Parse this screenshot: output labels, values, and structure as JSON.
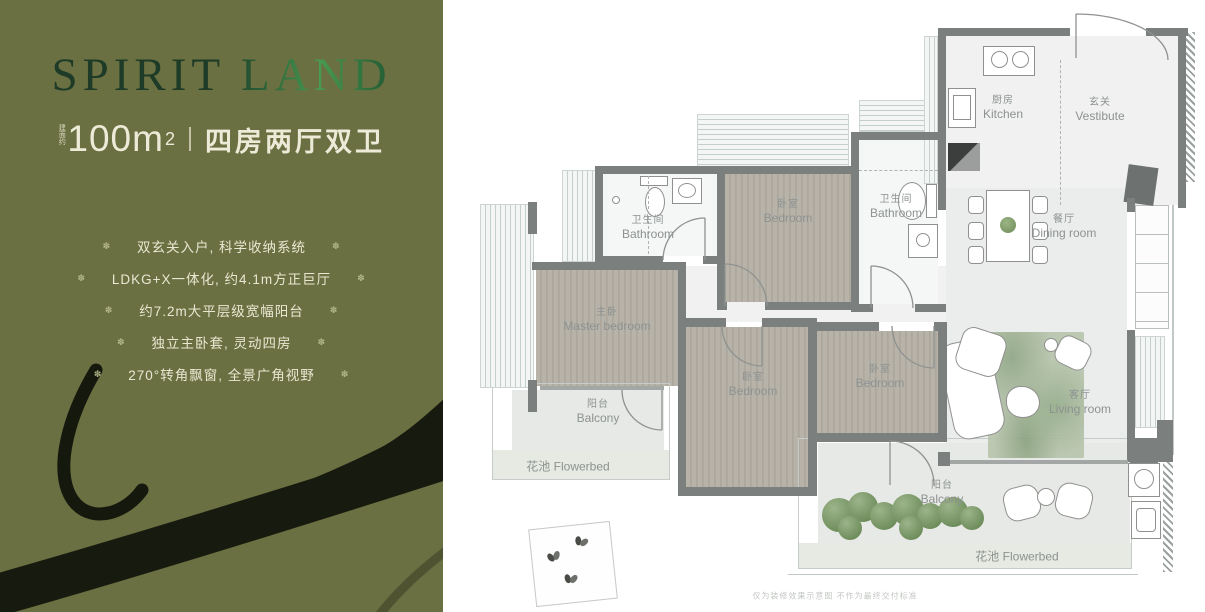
{
  "left_panel": {
    "title": "SPIRIT LAND",
    "area": {
      "prefix_vertical": "建面约",
      "value": "100m",
      "superscript": "2",
      "layout": "四房两厅双卫"
    },
    "bullet_glyph": "✽",
    "features": [
      "双玄关入户, 科学收纳系统",
      "LDKG+X一体化, 约4.1m方正巨厅",
      "约7.2m大平层级宽幅阳台",
      "独立主卧套, 灵动四房",
      "270°转角飘窗, 全景广角视野"
    ],
    "colors": {
      "panel_bg": "#6b7042",
      "title_dark": "#1d3b27",
      "title_bright": "#4a9a52",
      "text_cream": "#e9e7d2"
    }
  },
  "floor_plan": {
    "rooms": {
      "kitchen": {
        "zh": "厨房",
        "en": "Kitchen"
      },
      "vestibule": {
        "zh": "玄关",
        "en": "Vestibute"
      },
      "bathroom_left": {
        "zh": "卫生间",
        "en": "Bathroom"
      },
      "bedroom_top": {
        "zh": "卧室",
        "en": "Bedroom"
      },
      "bathroom_right": {
        "zh": "卫生间",
        "en": "Bathroom"
      },
      "dining_room": {
        "zh": "餐厅",
        "en": "Dining room"
      },
      "master_bedroom": {
        "zh": "主卧",
        "en": "Master bedroom"
      },
      "bedroom_middle": {
        "zh": "卧室",
        "en": "Bedroom"
      },
      "bedroom_right": {
        "zh": "卧室",
        "en": "Bedroom"
      },
      "living_room": {
        "zh": "客厅",
        "en": "Living room"
      },
      "balcony_left": {
        "zh": "阳台",
        "en": "Balcony"
      },
      "balcony_bottom": {
        "zh": "阳台",
        "en": "Balcony"
      },
      "flowerbed_left": {
        "zh": "花池",
        "en": "Flowerbed"
      },
      "flowerbed_bottom": {
        "zh": "花池",
        "en": "Flowerbed"
      }
    },
    "wall_color": "#7b7f7d",
    "wood_color": "#b1aca2",
    "disclaimer": "仅为装修效果示意图 不作为最终交付标准"
  }
}
